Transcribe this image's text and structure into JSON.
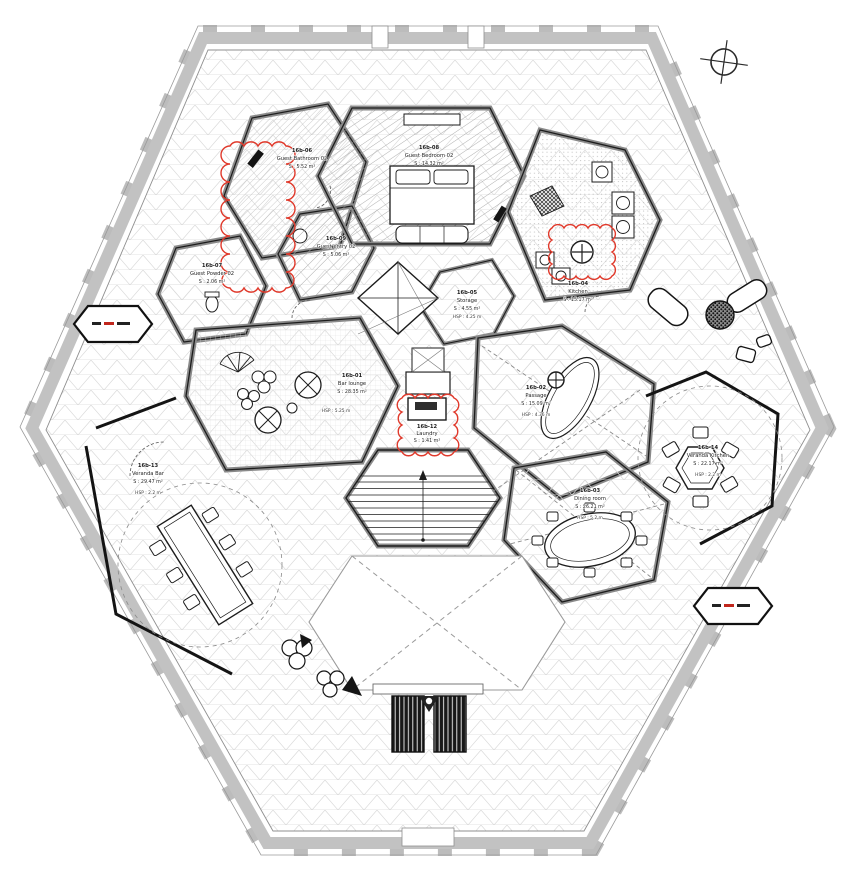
{
  "drawing": {
    "kind": "architectural floor plan, hexagonal villa level",
    "north_indicator": "compass-cross"
  },
  "colors": {
    "paper": "#ffffff",
    "parapet_gray": "#bcbcbc",
    "line_dark": "#1c1c1c",
    "grid_gray": "#d9d9d9",
    "revision_red": "#e0392b"
  },
  "rooms": {
    "bar_lounge": {
      "id": "16b-01",
      "name": "Bar lounge",
      "area": "S : 28.35 m²",
      "note": "HSP : 5.25 m"
    },
    "hall": {
      "id": "16b-02",
      "name": "Passage",
      "area": "S : 15.09 m²",
      "note": "HSP : 4.36 m"
    },
    "dining": {
      "id": "16b-03",
      "name": "Dining room",
      "area": "S : 26.21 m²",
      "note": "HSP : 5.2 m"
    },
    "kitchen": {
      "id": "16b-04",
      "name": "Kitchen",
      "area": "S : 15.17 m²"
    },
    "storage": {
      "id": "16b-05",
      "name": "Storage",
      "area": "S : 4.55 m²",
      "note": "HSP : 4.25 m"
    },
    "laundry": {
      "id": "16b-12",
      "name": "Laundry",
      "area": "S : 1.41 m²"
    },
    "veranda_bar": {
      "id": "16b-13",
      "name": "Veranda Bar",
      "area": "S : 29.47 m²",
      "note": "HSP : 2.2 m"
    },
    "veranda_kitchen": {
      "id": "16b-14",
      "name": "Veranda Kitchen",
      "area": "S : 22.17 m²",
      "note": "HSP : 2.2 m"
    },
    "guest_bedroom": {
      "id": "16b-08",
      "name": "Guest Bedroom 02",
      "area": "S : 14.32 m²"
    },
    "guest_entry": {
      "id": "16b-09",
      "name": "Guest entry 02",
      "area": "S : 5.06 m²"
    },
    "guest_powder": {
      "id": "16b-07",
      "name": "Guest Powder 02",
      "area": "S : 2.06 m²"
    },
    "guest_bath": {
      "id": "16b-06",
      "name": "Guest Bathroom 02",
      "area": "S : 5.52 m²"
    }
  }
}
